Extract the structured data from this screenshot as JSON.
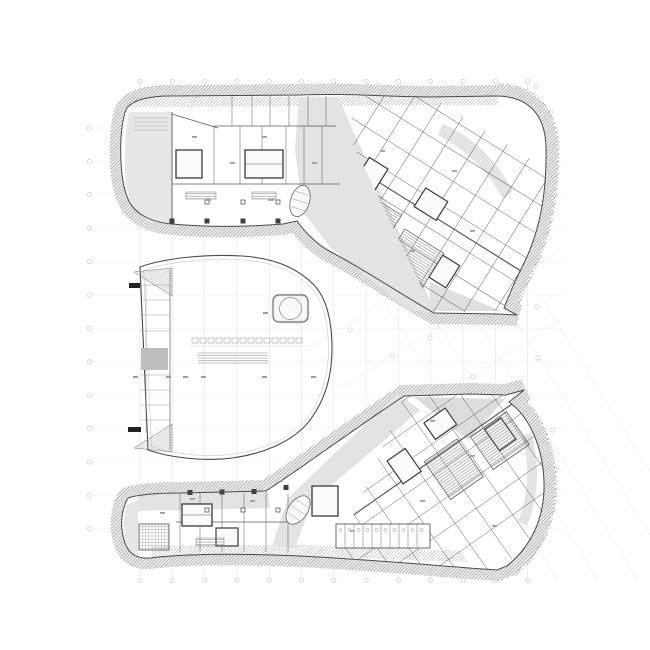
{
  "document": {
    "kind": "architectural-floor-plan",
    "aria_label": "Architectural floor plan: two curved hatched building wings (upper and lower) with a central lens-shaped atrium hall, column grid lines and grid bubbles",
    "legible_text_present": false
  },
  "palette": {
    "background": "#ffffff",
    "linework": "#4a4a4a",
    "wall_heavy": "#3a3a3a",
    "partition": "#5a5a5a",
    "poche_light": "#e3e3e3",
    "poche_medium": "#bdbdbd",
    "hatch_line": "#8f8f8f",
    "grid_line": "#e0e0e0",
    "grid_line_faint": "#eeeeee",
    "grid_bubble": "#c4c4c4",
    "accent_dark": "#222222"
  },
  "grid": {
    "vertical": {
      "start_x": 140,
      "spacing": 32.3,
      "count": 13,
      "y1": 84,
      "y2": 578
    },
    "horizontal": {
      "start_y": 128,
      "spacing": 33.4,
      "count": 13,
      "x1": 92,
      "x2": 562
    },
    "diagonal": {
      "start_x": 248,
      "spacing": 40,
      "count": 5,
      "dx": 309,
      "y1": 84,
      "y2": 578
    },
    "anti_diagonal_lines": [
      [
        300,
        355,
        560,
        192
      ],
      [
        340,
        388,
        560,
        251
      ],
      [
        386,
        430,
        560,
        321
      ]
    ],
    "bubble_radius": 2.2
  },
  "regions": {
    "upper_wing": "upper office wing with curved hatched facade",
    "lower_wing": "lower office wing with curved hatched facade",
    "atrium": "central atrium hall",
    "escalators": "oval escalator cores",
    "pavilion": "rounded pavilion with circular stage",
    "service_cores": "heavy-walled service cores",
    "corridors": "grey circulation corridors"
  }
}
